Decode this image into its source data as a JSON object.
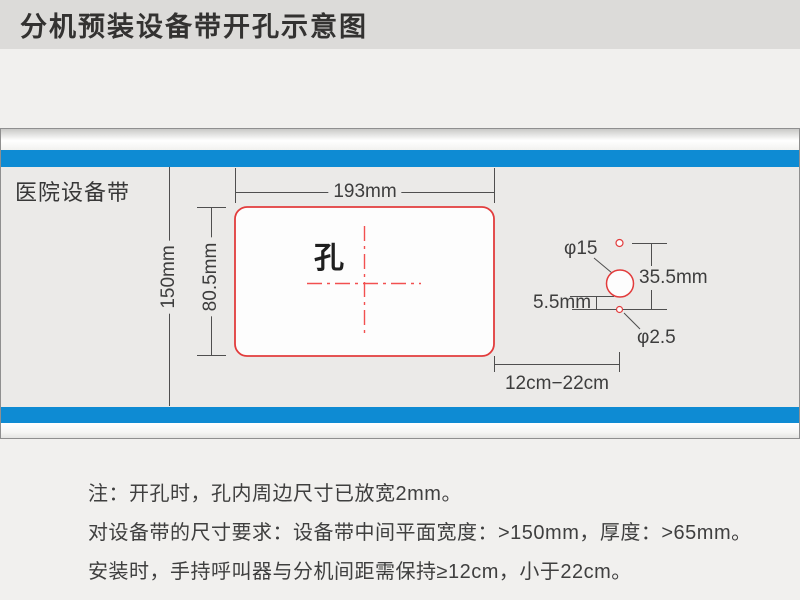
{
  "title": "分机预装设备带开孔示意图",
  "band": {
    "label": "医院设备带"
  },
  "hole": {
    "label": "孔"
  },
  "dimensions": {
    "hole_width": "193mm",
    "hole_height": "80.5mm",
    "band_width": "150mm",
    "large_hole_diameter": "φ15",
    "small_hole_diameter": "φ2.5",
    "hole_vertical_spacing": "35.5mm",
    "hole_edge_offset": "5.5mm",
    "distance_range": "12cm−22cm"
  },
  "notes": [
    "注：开孔时，孔内周边尺寸已放宽2mm。",
    "对设备带的尺寸要求：设备带中间平面宽度：>150mm，厚度：>65mm。",
    "安装时，手持呼叫器与分机间距需保持≥12cm，小于22cm。"
  ],
  "colors": {
    "stripe_blue": "#0e8bd3",
    "outline_red": "#e23c3c",
    "centerline_red": "#f25050",
    "dimension_line_gray": "#4f4f4f",
    "titlebar_gray": "#dcdbd9",
    "band_gray": "#ebeae8"
  }
}
